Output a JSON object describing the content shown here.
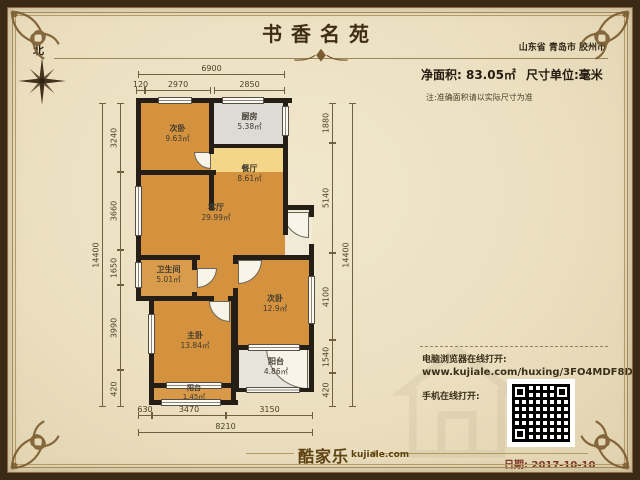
{
  "header": {
    "title": "书香名苑",
    "location": "山东省 青岛市 胶州市",
    "net_area": "净面积: 83.05㎡",
    "unit": "尺寸单位:毫米",
    "note": "注:准确面积请以实际尺寸为准",
    "north": "北"
  },
  "rooms": [
    {
      "name": "次卧",
      "area": "9.63㎡"
    },
    {
      "name": "厨房",
      "area": "5.38㎡"
    },
    {
      "name": "餐厅",
      "area": "8.61㎡"
    },
    {
      "name": "客厅",
      "area": "29.99㎡"
    },
    {
      "name": "卫生间",
      "area": "5.01㎡"
    },
    {
      "name": "次卧",
      "area": "12.9㎡"
    },
    {
      "name": "主卧",
      "area": "13.84㎡"
    },
    {
      "name": "阳台",
      "area": "4.86㎡"
    },
    {
      "name": "阳台",
      "area": "1.45㎡"
    }
  ],
  "dims": {
    "top_total": "6900",
    "top_segments": [
      "120",
      "2970",
      "2850"
    ],
    "left_total": "14400",
    "left_segments": [
      "3240",
      "3660",
      "1650",
      "3990",
      "420"
    ],
    "right_total": "14400",
    "right_segments": [
      "1880",
      "5140",
      "4100",
      "1540",
      "420"
    ],
    "bottom_segments": [
      "630",
      "3470",
      "3150"
    ],
    "bottom_total": "8210"
  },
  "share": {
    "desktop_label": "电脑浏览器在线打开:",
    "url": "www.kujiale.com/huxing/3FO4MDF8DUBI",
    "mobile_label": "手机在线打开:"
  },
  "footer": {
    "brand": "酷家乐",
    "brand_domain": "kujiale.com",
    "date": "日期: 2017-10-10"
  },
  "colors": {
    "wall": "#241e16",
    "bedroom_fill": "#d4923f",
    "bath_fill": "#d99c4c",
    "dining_fill": "#f3d687",
    "kitchen_fill": "#dcdbd5",
    "balcony_fill": "#e7e4db",
    "frame_brown": "#3b2a16",
    "accent_gold": "#a48a58",
    "date_red": "#7d3528",
    "paper": "#ebdfc0"
  }
}
